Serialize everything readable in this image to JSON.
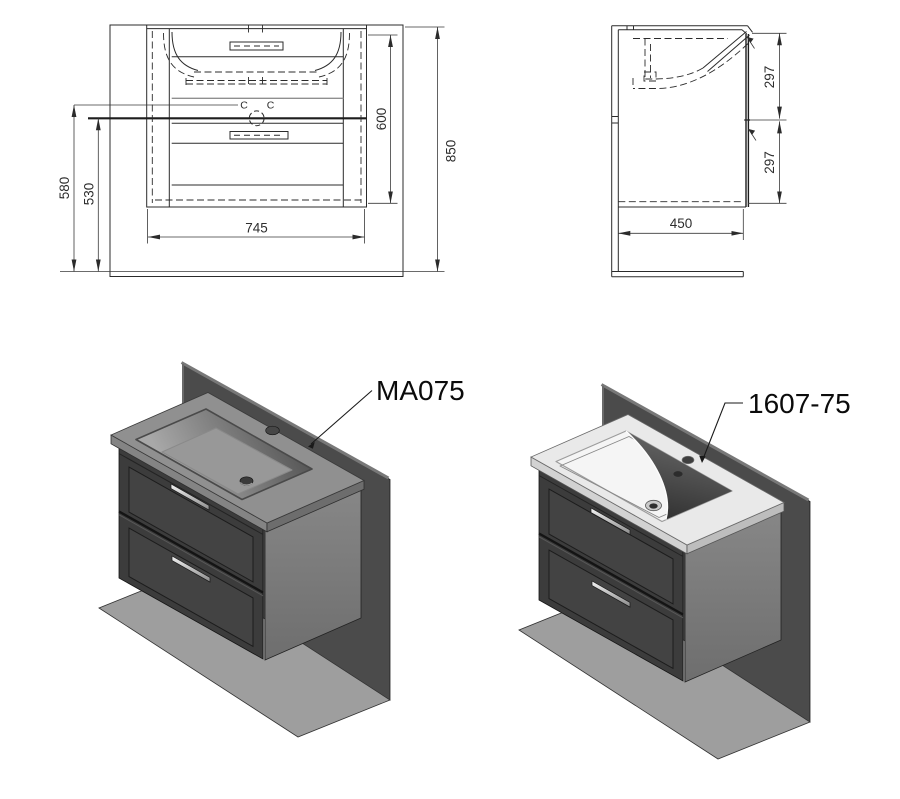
{
  "front_view": {
    "dim_580": "580",
    "dim_530": "530",
    "dim_600": "600",
    "dim_850": "850",
    "dim_745": "745",
    "mark_c_left": "C",
    "mark_c_right": "C"
  },
  "side_view": {
    "dim_297_top": "297",
    "dim_297_bottom": "297",
    "dim_450": "450"
  },
  "products": {
    "left_label": "MA075",
    "right_label": "1607-75"
  },
  "colors": {
    "line": "#2b2b2b",
    "dim_text": "#2e2e2e",
    "wall": "#4b4b4b",
    "floor": "#9e9e9e",
    "cabinet_front": "#3c3c3c",
    "cabinet_side": "#7c7c7c",
    "counter_gray": "#909090",
    "counter_white": "#e9e9e9",
    "bowl_shadow": "#4a4a4a",
    "chrome": "#e8e8e8"
  }
}
